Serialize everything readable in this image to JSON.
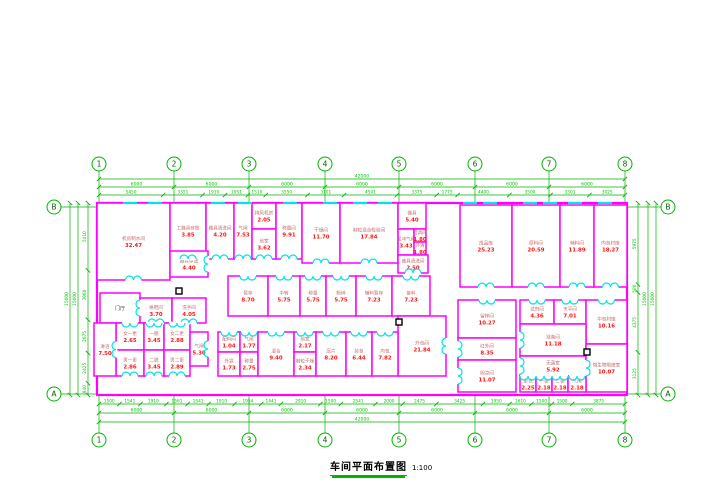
{
  "title": {
    "text": "车间平面布置图",
    "scale": "1:100"
  },
  "colors": {
    "wall": "#FF00FF",
    "door": "#00E5E5",
    "dim_line": "#00B400",
    "dim_text": "#00C800",
    "bubble": "#00B400",
    "bubble_text": "#006600",
    "room_name": "#C86A6A",
    "room_area": "#FF1414",
    "plain_text": "#444444",
    "marker": "#000000"
  },
  "grid": {
    "cols": [
      "1",
      "2",
      "3",
      "4",
      "5",
      "6",
      "7",
      "8"
    ],
    "rows": [
      "B",
      "A"
    ],
    "col_x": [
      99,
      174,
      249,
      325,
      399,
      475,
      549,
      625
    ],
    "row_y": [
      207,
      394
    ]
  },
  "dimensions": {
    "top": {
      "total": "42000",
      "majors": [
        "6000",
        "6000",
        "6000",
        "6000",
        "6000",
        "6000",
        "6000"
      ],
      "details": [
        "5450",
        "3351",
        "1910",
        "1951",
        "1510",
        "3550",
        "3101",
        "4501",
        "3375",
        "1775",
        "4400",
        "3500",
        "3301",
        "3025"
      ]
    },
    "bottom": {
      "total": "42000",
      "majors": [
        "6000",
        "6000",
        "6000",
        "6000",
        "6000",
        "6000",
        "6000"
      ],
      "details": [
        "1500",
        "1541",
        "1910",
        "1561",
        "1541",
        "1910",
        "1954",
        "1441",
        "2910",
        "1500",
        "2541",
        "2000",
        "2475",
        "3425",
        "1950",
        "1610",
        "1500",
        "1500",
        "3875"
      ]
    },
    "left": {
      "totals": [
        "15000",
        "15000"
      ],
      "details": [
        "5410",
        "3960",
        "2675",
        "2425",
        "940"
      ]
    },
    "right": {
      "totals": [
        "15000",
        "15000"
      ],
      "details": [
        "5975",
        "580",
        "4375",
        "3125"
      ]
    },
    "interior": [
      {
        "t": "5025",
        "x": 246,
        "y": 284
      },
      {
        "t": "2000",
        "x": 284,
        "y": 284
      },
      {
        "t": "2000",
        "x": 313,
        "y": 284
      },
      {
        "t": "2000",
        "x": 341,
        "y": 284
      },
      {
        "t": "2510",
        "x": 372,
        "y": 284
      },
      {
        "t": "2500",
        "x": 410,
        "y": 284
      },
      {
        "t": "1425",
        "x": 136,
        "y": 319
      },
      {
        "t": "1251",
        "x": 158,
        "y": 319
      },
      {
        "t": "1575",
        "x": 404,
        "y": 262
      },
      {
        "t": "1000",
        "x": 424,
        "y": 262
      },
      {
        "t": "1610",
        "x": 527,
        "y": 293
      },
      {
        "t": "2125",
        "x": 553,
        "y": 293
      },
      {
        "t": "3150",
        "x": 582,
        "y": 293
      },
      {
        "t": "2625",
        "x": 612,
        "y": 293
      },
      {
        "t": "990",
        "x": 220,
        "y": 381
      },
      {
        "t": "3575",
        "x": 290,
        "y": 243,
        "r": 90
      },
      {
        "t": "2318",
        "x": 454,
        "y": 312,
        "r": 90
      },
      {
        "t": "2301",
        "x": 454,
        "y": 340,
        "r": 90
      },
      {
        "t": "1520",
        "x": 454,
        "y": 368,
        "r": 90
      },
      {
        "t": "1775",
        "x": 436,
        "y": 226,
        "r": 90
      },
      {
        "t": "1064",
        "x": 436,
        "y": 258,
        "r": 90
      },
      {
        "t": "3475",
        "x": 206,
        "y": 230,
        "r": 90
      },
      {
        "t": "2175",
        "x": 206,
        "y": 265,
        "r": 90
      },
      {
        "t": "1075",
        "x": 114,
        "y": 336,
        "r": 90
      },
      {
        "t": "1850",
        "x": 114,
        "y": 362,
        "r": 90
      }
    ]
  },
  "plan": {
    "outline": {
      "x": 97,
      "y": 203,
      "w": 530,
      "h": 192
    },
    "window_xs": [
      130,
      155,
      218,
      245,
      290,
      330,
      360,
      385,
      470,
      490,
      530,
      550,
      575,
      605
    ],
    "markers": [
      {
        "x": 176,
        "y": 288
      },
      {
        "x": 396,
        "y": 319
      },
      {
        "x": 584,
        "y": 349
      }
    ],
    "rooms": [
      {
        "n": "机房制水间",
        "a": "32.47",
        "x": 97,
        "y": 203,
        "w": 73,
        "h": 77,
        "d": "bottom"
      },
      {
        "n": "工器具存放",
        "a": "3.85",
        "x": 170,
        "y": 203,
        "w": 36,
        "h": 56,
        "d": "bottom"
      },
      {
        "n": "器具清洗间",
        "a": "4.20",
        "x": 206,
        "y": 203,
        "w": 28,
        "h": 56,
        "d": "bottom"
      },
      {
        "n": "气闸",
        "a": "7.53",
        "x": 234,
        "y": 203,
        "w": 18,
        "h": 56,
        "d": "bottom"
      },
      {
        "n": "排风机房",
        "a": "2.05",
        "x": 252,
        "y": 203,
        "w": 24,
        "h": 26,
        "d": null
      },
      {
        "n": "前室",
        "a": "3.62",
        "x": 252,
        "y": 229,
        "w": 24,
        "h": 30,
        "d": "bottom"
      },
      {
        "n": "称量间",
        "a": "9.91",
        "x": 276,
        "y": 203,
        "w": 26,
        "h": 56,
        "d": "bottom"
      },
      {
        "n": "干燥间",
        "a": "11.70",
        "x": 302,
        "y": 203,
        "w": 38,
        "h": 60,
        "d": "bottom"
      },
      {
        "n": "制粒混合检验间",
        "a": "17.84",
        "x": 340,
        "y": 203,
        "w": 58,
        "h": 60,
        "d": "bottom"
      },
      {
        "n": "器具",
        "a": "5.40",
        "x": 398,
        "y": 203,
        "w": 28,
        "h": 26,
        "d": null
      },
      {
        "n": "缓冲气闸",
        "a": "3.43",
        "x": 398,
        "y": 229,
        "w": 16,
        "h": 26,
        "d": null
      },
      {
        "n": "洁具间",
        "a": "1.80",
        "x": 414,
        "y": 229,
        "w": 12,
        "h": 13,
        "d": null
      },
      {
        "n": "外清",
        "a": "1.80",
        "x": 414,
        "y": 242,
        "w": 12,
        "h": 13,
        "d": null
      },
      {
        "n": "器具清洗间",
        "a": "2.50",
        "x": 398,
        "y": 255,
        "w": 30,
        "h": 18,
        "d": "bottom"
      },
      {
        "n": "器具存放",
        "a": "4.40",
        "x": 170,
        "y": 251,
        "w": 38,
        "h": 26,
        "d": "right"
      },
      {
        "n": "成品库",
        "a": "25.23",
        "x": 460,
        "y": 205,
        "w": 52,
        "h": 82,
        "d": "bottom"
      },
      {
        "n": "原料间",
        "a": "20.59",
        "x": 512,
        "y": 205,
        "w": 48,
        "h": 82,
        "d": "bottom"
      },
      {
        "n": "辅料间",
        "a": "11.89",
        "x": 560,
        "y": 205,
        "w": 34,
        "h": 82,
        "d": "bottom"
      },
      {
        "n": "内包材库",
        "a": "18.27",
        "x": 594,
        "y": 205,
        "w": 33,
        "h": 82,
        "d": "bottom"
      },
      {
        "n": "暂存",
        "a": "8.70",
        "x": 228,
        "y": 276,
        "w": 40,
        "h": 40,
        "d": "top"
      },
      {
        "n": "中转",
        "a": "5.75",
        "x": 268,
        "y": 276,
        "w": 32,
        "h": 40,
        "d": "top"
      },
      {
        "n": "称量",
        "a": "5.75",
        "x": 300,
        "y": 276,
        "w": 26,
        "h": 40,
        "d": "top"
      },
      {
        "n": "粉碎",
        "a": "5.75",
        "x": 326,
        "y": 276,
        "w": 30,
        "h": 40,
        "d": "top"
      },
      {
        "n": "辅料暂存",
        "a": "7.23",
        "x": 356,
        "y": 276,
        "w": 36,
        "h": 40,
        "d": "top"
      },
      {
        "n": "备料",
        "a": "7.23",
        "x": 392,
        "y": 276,
        "w": 38,
        "h": 40,
        "d": "top"
      },
      {
        "n": "外包间",
        "a": "21.84",
        "x": 398,
        "y": 316,
        "w": 48,
        "h": 60,
        "d": "right"
      },
      {
        "n": "配料间",
        "a": "1.04",
        "x": 218,
        "y": 332,
        "w": 22,
        "h": 20,
        "d": "top"
      },
      {
        "n": "气闸",
        "a": "1.77",
        "x": 240,
        "y": 332,
        "w": 18,
        "h": 20,
        "d": "top"
      },
      {
        "n": "外袋",
        "a": "1.73",
        "x": 218,
        "y": 352,
        "w": 22,
        "h": 24,
        "d": null
      },
      {
        "n": "称量",
        "a": "2.75",
        "x": 240,
        "y": 352,
        "w": 18,
        "h": 24,
        "d": null
      },
      {
        "n": "混合",
        "a": "9.40",
        "x": 258,
        "y": 332,
        "w": 36,
        "h": 44,
        "d": "top"
      },
      {
        "n": "前室",
        "a": "2.17",
        "x": 294,
        "y": 332,
        "w": 22,
        "h": 20,
        "d": "top"
      },
      {
        "n": "制粒干燥",
        "a": "2.34",
        "x": 294,
        "y": 352,
        "w": 22,
        "h": 24,
        "d": null
      },
      {
        "n": "压片",
        "a": "8.20",
        "x": 316,
        "y": 332,
        "w": 30,
        "h": 44,
        "d": "top"
      },
      {
        "n": "装包",
        "a": "6.44",
        "x": 346,
        "y": 332,
        "w": 26,
        "h": 44,
        "d": "top"
      },
      {
        "n": "内包",
        "a": "7.82",
        "x": 372,
        "y": 332,
        "w": 26,
        "h": 44,
        "d": "top"
      },
      {
        "n": "门厅",
        "a": "",
        "x": 100,
        "y": 293,
        "w": 40,
        "h": 30,
        "d": "right"
      },
      {
        "n": "换鞋间",
        "a": "3.70",
        "x": 140,
        "y": 298,
        "w": 32,
        "h": 25,
        "d": "bottom"
      },
      {
        "n": "洗手间",
        "a": "4.05",
        "x": 172,
        "y": 298,
        "w": 34,
        "h": 25,
        "d": "bottom"
      },
      {
        "n": "女一更",
        "a": "2.65",
        "x": 116,
        "y": 323,
        "w": 28,
        "h": 27,
        "d": "top"
      },
      {
        "n": "一脱",
        "a": "3.45",
        "x": 144,
        "y": 323,
        "w": 20,
        "h": 27,
        "d": "top"
      },
      {
        "n": "女二更",
        "a": "2.88",
        "x": 164,
        "y": 323,
        "w": 26,
        "h": 27,
        "d": "top"
      },
      {
        "n": "男一更",
        "a": "2.86",
        "x": 116,
        "y": 350,
        "w": 28,
        "h": 26,
        "d": "bottom"
      },
      {
        "n": "二脱",
        "a": "3.45",
        "x": 144,
        "y": 350,
        "w": 20,
        "h": 26,
        "d": "bottom"
      },
      {
        "n": "男二更",
        "a": "2.89",
        "x": 164,
        "y": 350,
        "w": 26,
        "h": 26,
        "d": "bottom"
      },
      {
        "n": "淋浴",
        "a": "7.50",
        "x": 94,
        "y": 323,
        "w": 22,
        "h": 53,
        "d": "right"
      },
      {
        "n": "气闸",
        "a": "5.30",
        "x": 190,
        "y": 332,
        "w": 18,
        "h": 34,
        "d": "right"
      },
      {
        "n": "留样间",
        "a": "10.27",
        "x": 458,
        "y": 300,
        "w": 58,
        "h": 38,
        "d": "top"
      },
      {
        "n": "红外间",
        "a": "8.35",
        "x": 458,
        "y": 338,
        "w": 58,
        "h": 22,
        "d": "left"
      },
      {
        "n": "阴凉间",
        "a": "11.07",
        "x": 458,
        "y": 360,
        "w": 58,
        "h": 32,
        "d": "left"
      },
      {
        "n": "试剂间",
        "a": "4.36",
        "x": 520,
        "y": 300,
        "w": 34,
        "h": 24,
        "d": "top"
      },
      {
        "n": "天平间",
        "a": "7.01",
        "x": 554,
        "y": 300,
        "w": 32,
        "h": 24,
        "d": "top"
      },
      {
        "n": "中包材库",
        "a": "10.16",
        "x": 586,
        "y": 300,
        "w": 41,
        "h": 44,
        "d": "top"
      },
      {
        "n": "准备间",
        "a": "11.18",
        "x": 520,
        "y": 324,
        "w": 66,
        "h": 32,
        "d": "left"
      },
      {
        "n": "无菌室",
        "a": "5.92",
        "x": 520,
        "y": 356,
        "w": 66,
        "h": 20,
        "d": "left"
      },
      {
        "n": "微生物限度室",
        "a": "10.07",
        "x": 586,
        "y": 344,
        "w": 41,
        "h": 48,
        "d": "left"
      },
      {
        "n": "更衣",
        "a": "2.25",
        "x": 520,
        "y": 376,
        "w": 16,
        "h": 16,
        "d": "top"
      },
      {
        "n": "一更",
        "a": "2.18",
        "x": 536,
        "y": 376,
        "w": 16,
        "h": 16,
        "d": "top"
      },
      {
        "n": "二更",
        "a": "2.18",
        "x": 552,
        "y": 376,
        "w": 16,
        "h": 16,
        "d": "top"
      },
      {
        "n": "气闸",
        "a": "2.18",
        "x": 568,
        "y": 376,
        "w": 18,
        "h": 16,
        "d": "top"
      }
    ]
  }
}
